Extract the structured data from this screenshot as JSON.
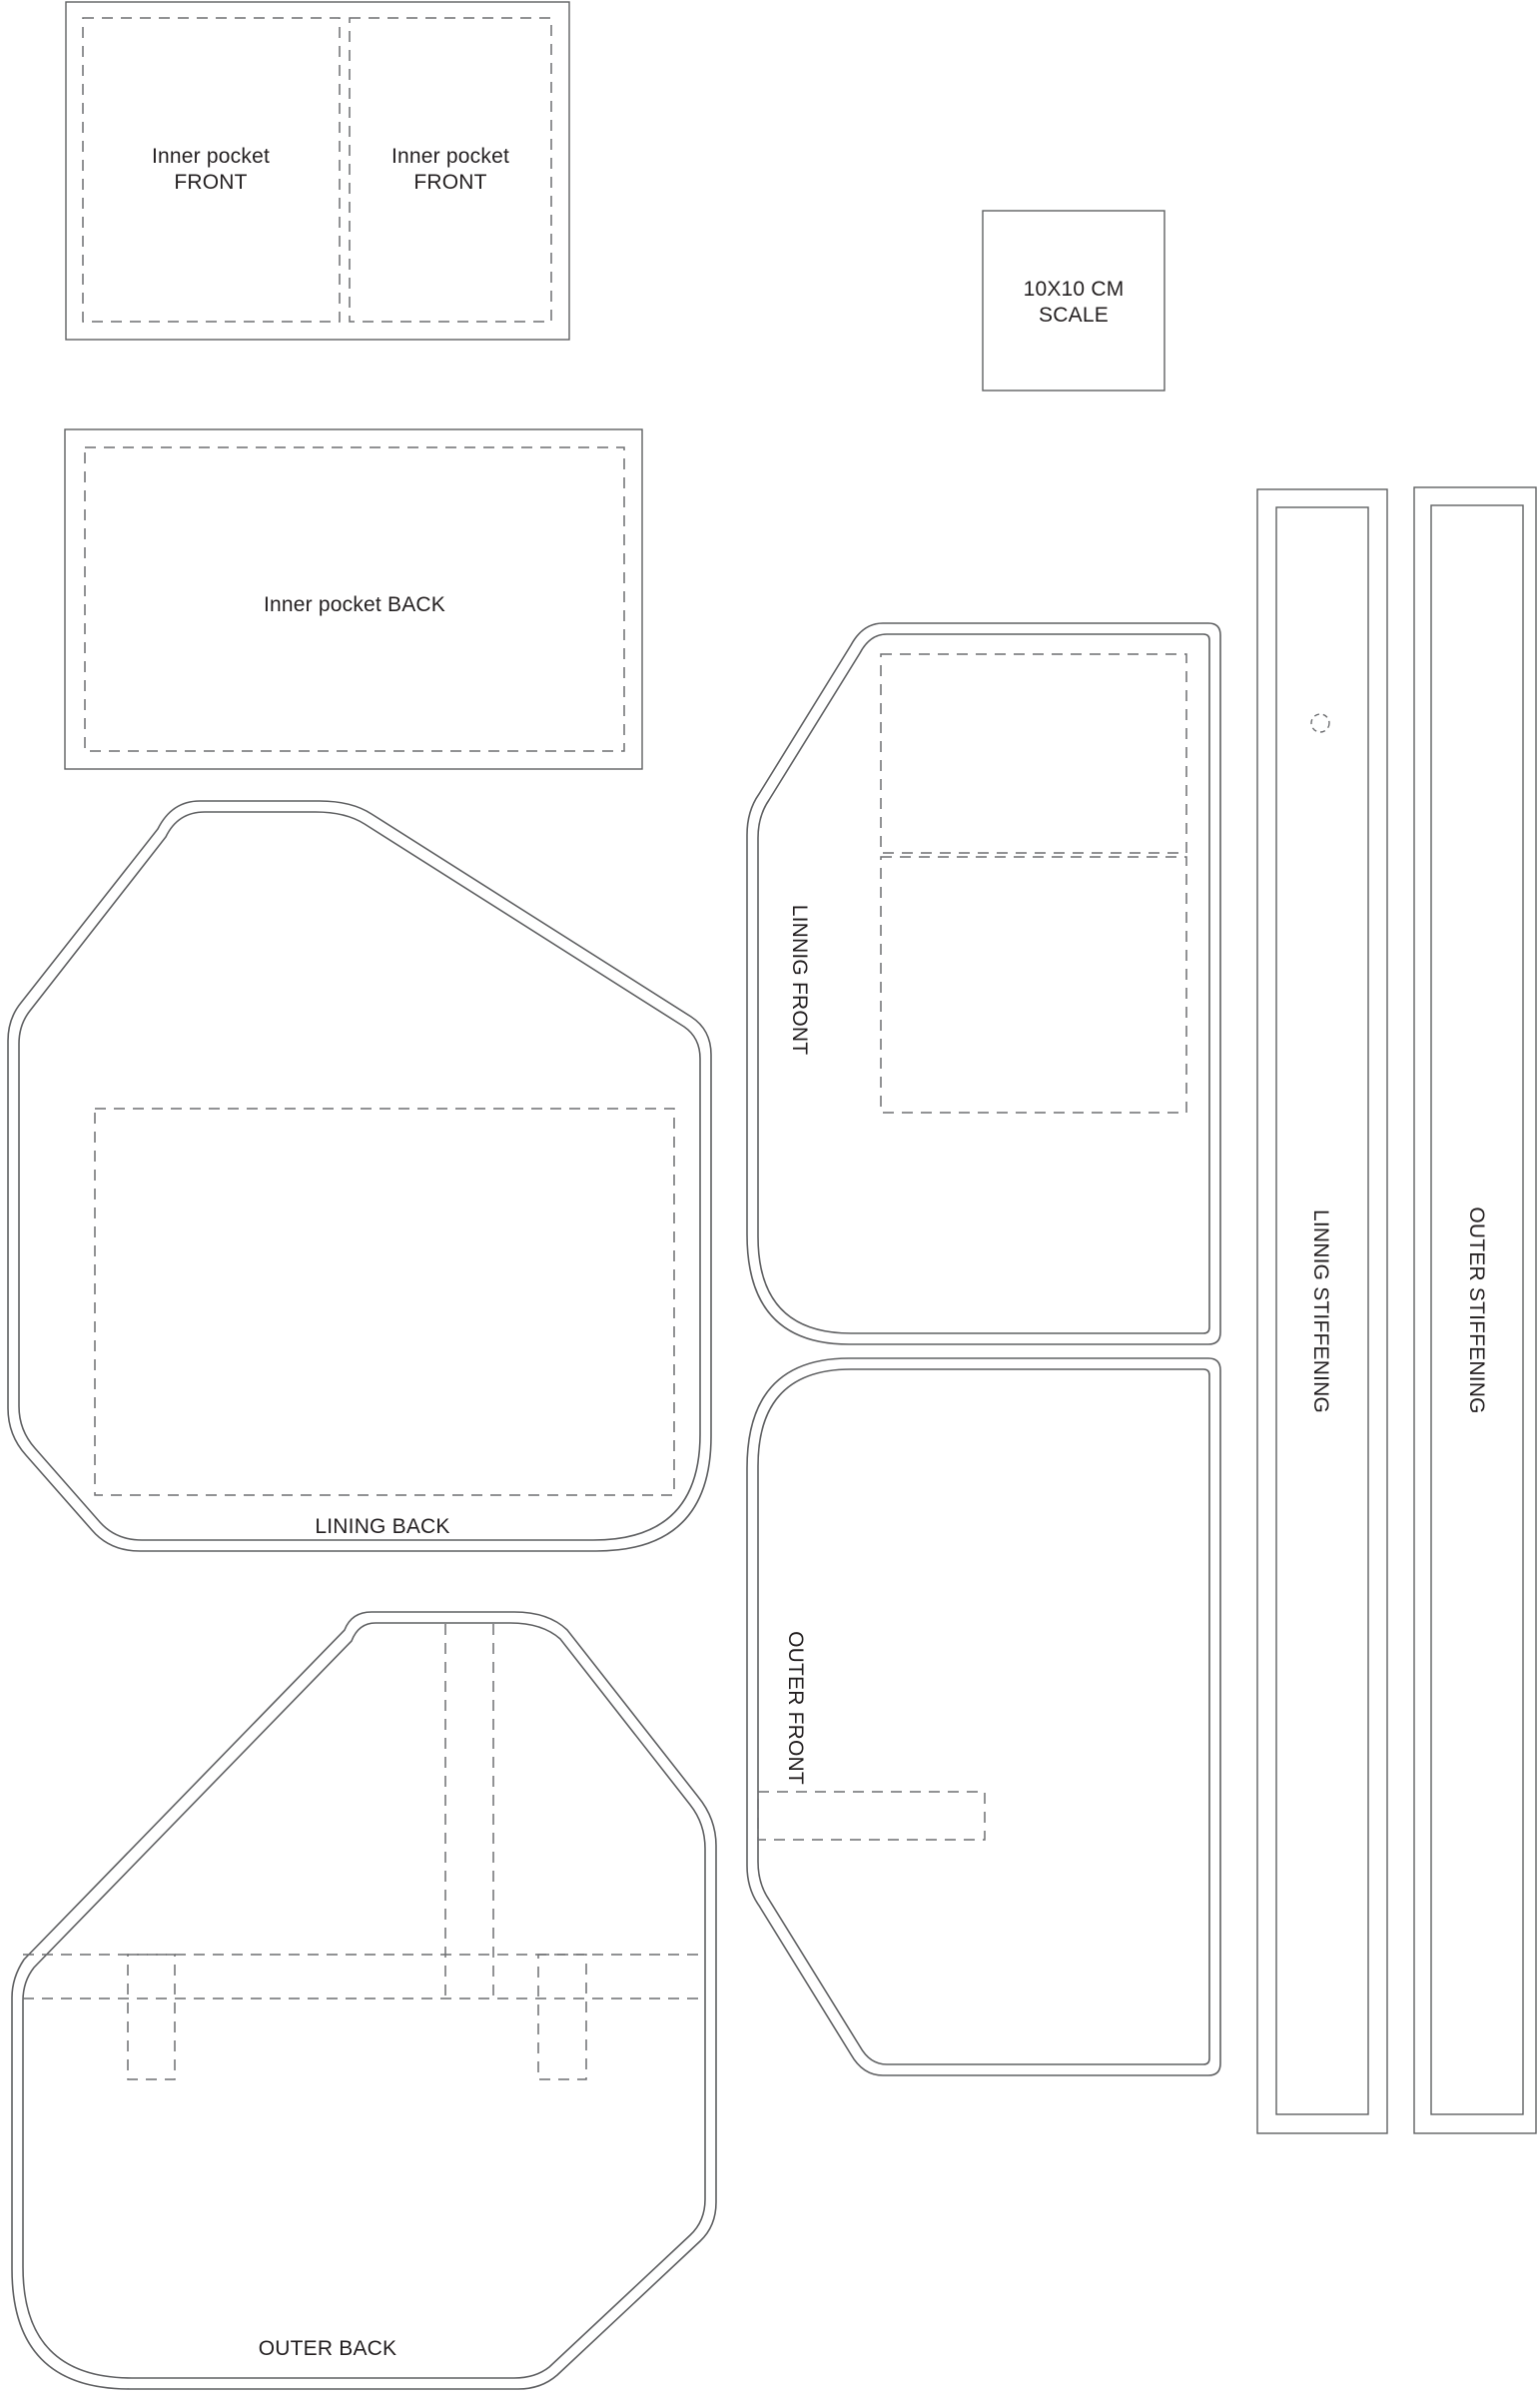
{
  "page": {
    "background_color": "#ffffff",
    "line_color": "#5f6062",
    "dash_color": "#6d6e71",
    "text_color": "#231f20"
  },
  "pieces": {
    "inner_pocket_front_left": {
      "label_line1": "Inner pocket",
      "label_line2": "FRONT"
    },
    "inner_pocket_front_right": {
      "label_line1": "Inner pocket",
      "label_line2": "FRONT"
    },
    "scale_box": {
      "label_line1": "10X10 CM",
      "label_line2": "SCALE"
    },
    "inner_pocket_back": {
      "label": "Inner pocket BACK"
    },
    "lining_back": {
      "label": "LINING BACK"
    },
    "linnig_front": {
      "label": "LINNIG FRONT"
    },
    "outer_front": {
      "label": "OUTER FRONT"
    },
    "outer_back": {
      "label": "OUTER BACK"
    },
    "linnig_stiffening": {
      "label": "LINNIG STIFFENING"
    },
    "outer_stiffening": {
      "label": "OUTER STIFFENING"
    }
  }
}
